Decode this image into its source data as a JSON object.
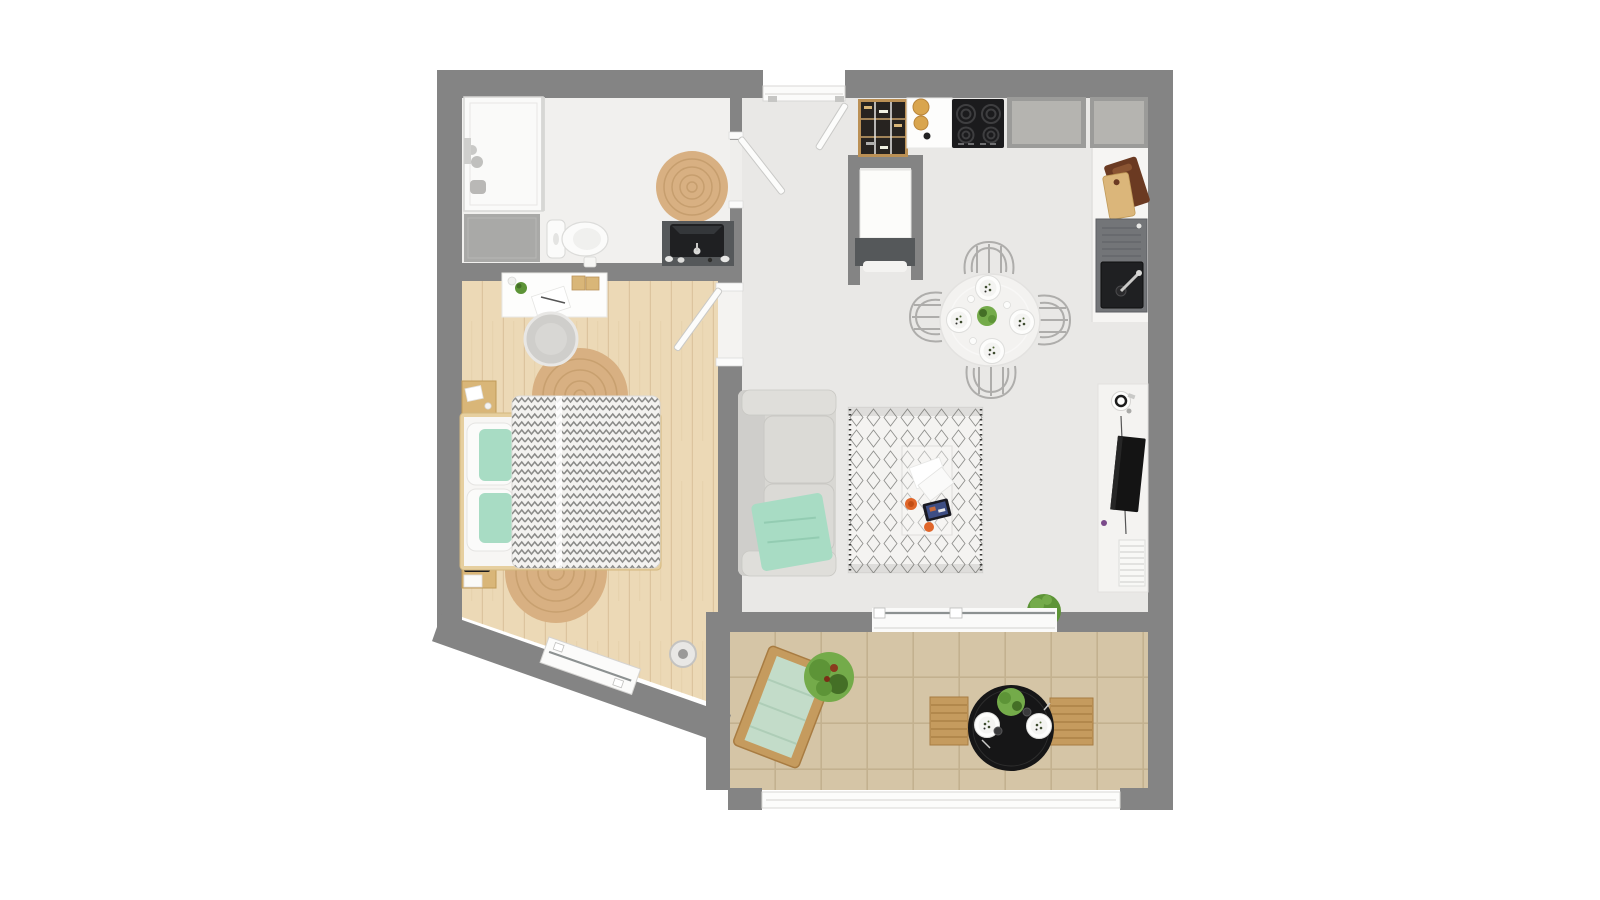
{
  "colors": {
    "background": "#ffffff",
    "wall": "#848484",
    "bathroom_floor": "#f1f0ee",
    "main_floor": "#e9e8e6",
    "wood_floor": "#ecd9b6",
    "wood_line": "#dcc49e",
    "tile": "#d5c5a6",
    "grout": "#c3b18f",
    "jute": "#d8b082",
    "jute_ring": "#bb9360",
    "door_white": "#fbfbfa",
    "mint": "#a8dcc4",
    "mint_pale": "#c3dcc9",
    "sofa": "#d8d7d3",
    "cushion": "#dfdeda",
    "duvet": "#f3f2f0",
    "chevron_line": "#8b8b89",
    "counter_dark": "#9b9b99",
    "counter_light": "#b5b4b0",
    "steel": "#737578",
    "basin": "#1f2022",
    "cooktop": "#1b1b1d",
    "appliance_front": "#55585a",
    "wood_tan": "#c59b5e",
    "wood_deep": "#a87c42",
    "shelf_wood": "#bb9055",
    "board_dark": "#6b3a22",
    "board_light": "#dbb67a",
    "green": "#5d9437",
    "green_dark": "#446f26",
    "green_light": "#74ab4a",
    "black_table": "#161617",
    "tv": "#141414",
    "orange": "#e0662a",
    "wire": "#aeadab",
    "chair": "#cfcecb",
    "mat": "#a9a9a7",
    "glass_line": "#8c9191",
    "canister": "#d9a54e",
    "white": "#fcfcfb",
    "rug_berber": "#f4f3f1",
    "rug_fringe": "#3a3a38"
  },
  "rooms": {
    "bathroom": {
      "items": [
        "shower",
        "glass-partition",
        "shower-mat",
        "toilet",
        "vanity-sink",
        "jute-rug-small"
      ]
    },
    "bedroom": {
      "items": [
        "desk",
        "desk-chair",
        "jute-rug-top",
        "jute-rug-bottom",
        "nightstand-top",
        "nightstand-bottom",
        "double-bed",
        "chevron-duvet",
        "floor-speaker",
        "diagonal-window"
      ]
    },
    "hallway": {
      "items": [
        "entry-threshold",
        "front-door",
        "bathroom-door",
        "bedroom-door"
      ]
    },
    "kitchen": {
      "items": [
        "open-shelf",
        "jar-counter",
        "cooktop",
        "counter-section-a",
        "counter-section-b",
        "cutting-boards",
        "sink-unit",
        "tall-cabinet"
      ]
    },
    "living_room": {
      "items": [
        "sofa",
        "throw-blanket",
        "berber-rug",
        "coffee-table",
        "tablet",
        "dining-table",
        "dining-chairs",
        "tv-console",
        "tv",
        "magazine-stack",
        "sliding-door",
        "door-plant"
      ]
    },
    "balcony": {
      "items": [
        "lounge-chair",
        "outdoor-plant",
        "outdoor-table",
        "bench-left",
        "bench-right",
        "railing"
      ]
    }
  }
}
